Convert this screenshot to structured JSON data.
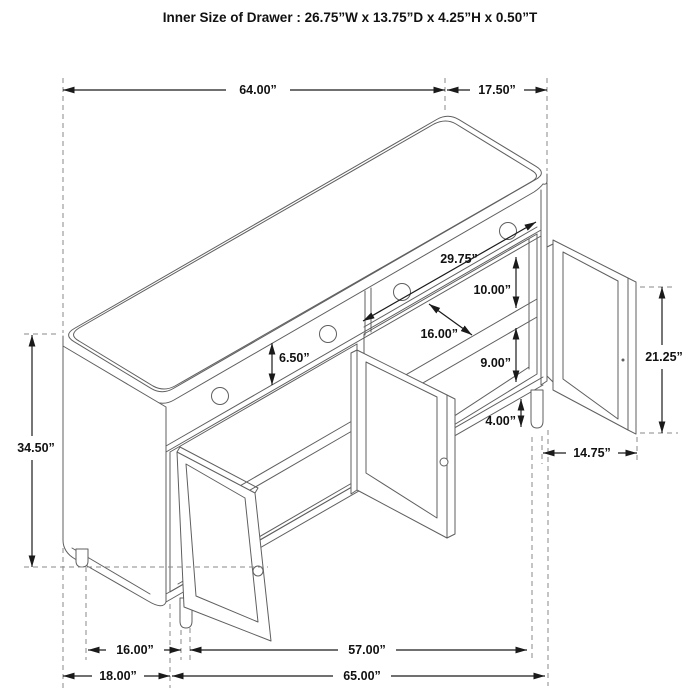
{
  "title": "Inner Size of Drawer : 26.75”W x 13.75”D x 4.25”H x 0.50”T",
  "dims": {
    "width_top": {
      "label": "64.00”",
      "meaning": "overall width (top)"
    },
    "depth_top": {
      "label": "17.50”",
      "meaning": "overall depth (top)"
    },
    "height_left": {
      "label": "34.50”",
      "meaning": "overall height"
    },
    "opening_width": {
      "label": "29.75”",
      "meaning": "double-door opening width"
    },
    "above_shelf": {
      "label": "10.00”",
      "meaning": "space above shelf"
    },
    "shelf_depth": {
      "label": "16.00”",
      "meaning": "shelf depth"
    },
    "drawer_front": {
      "label": "6.50”",
      "meaning": "drawer front height"
    },
    "below_shelf": {
      "label": "9.00”",
      "meaning": "space below shelf"
    },
    "leg_height": {
      "label": "4.00”",
      "meaning": "leg height"
    },
    "door_height": {
      "label": "21.25”",
      "meaning": "door height"
    },
    "door_width": {
      "label": "14.75”",
      "meaning": "door width"
    },
    "base_depth_inner": {
      "label": "16.00”",
      "meaning": "leg spacing depth"
    },
    "base_depth": {
      "label": "18.00”",
      "meaning": "base depth"
    },
    "base_width_inner": {
      "label": "57.00”",
      "meaning": "leg spacing width"
    },
    "base_width": {
      "label": "65.00”",
      "meaning": "base width"
    }
  },
  "colors": {
    "background": "#ffffff",
    "dimension_lines": "#1a1a1a",
    "drawing_lines": "#5f5f5f",
    "extension_lines": "#8a8a8a"
  }
}
